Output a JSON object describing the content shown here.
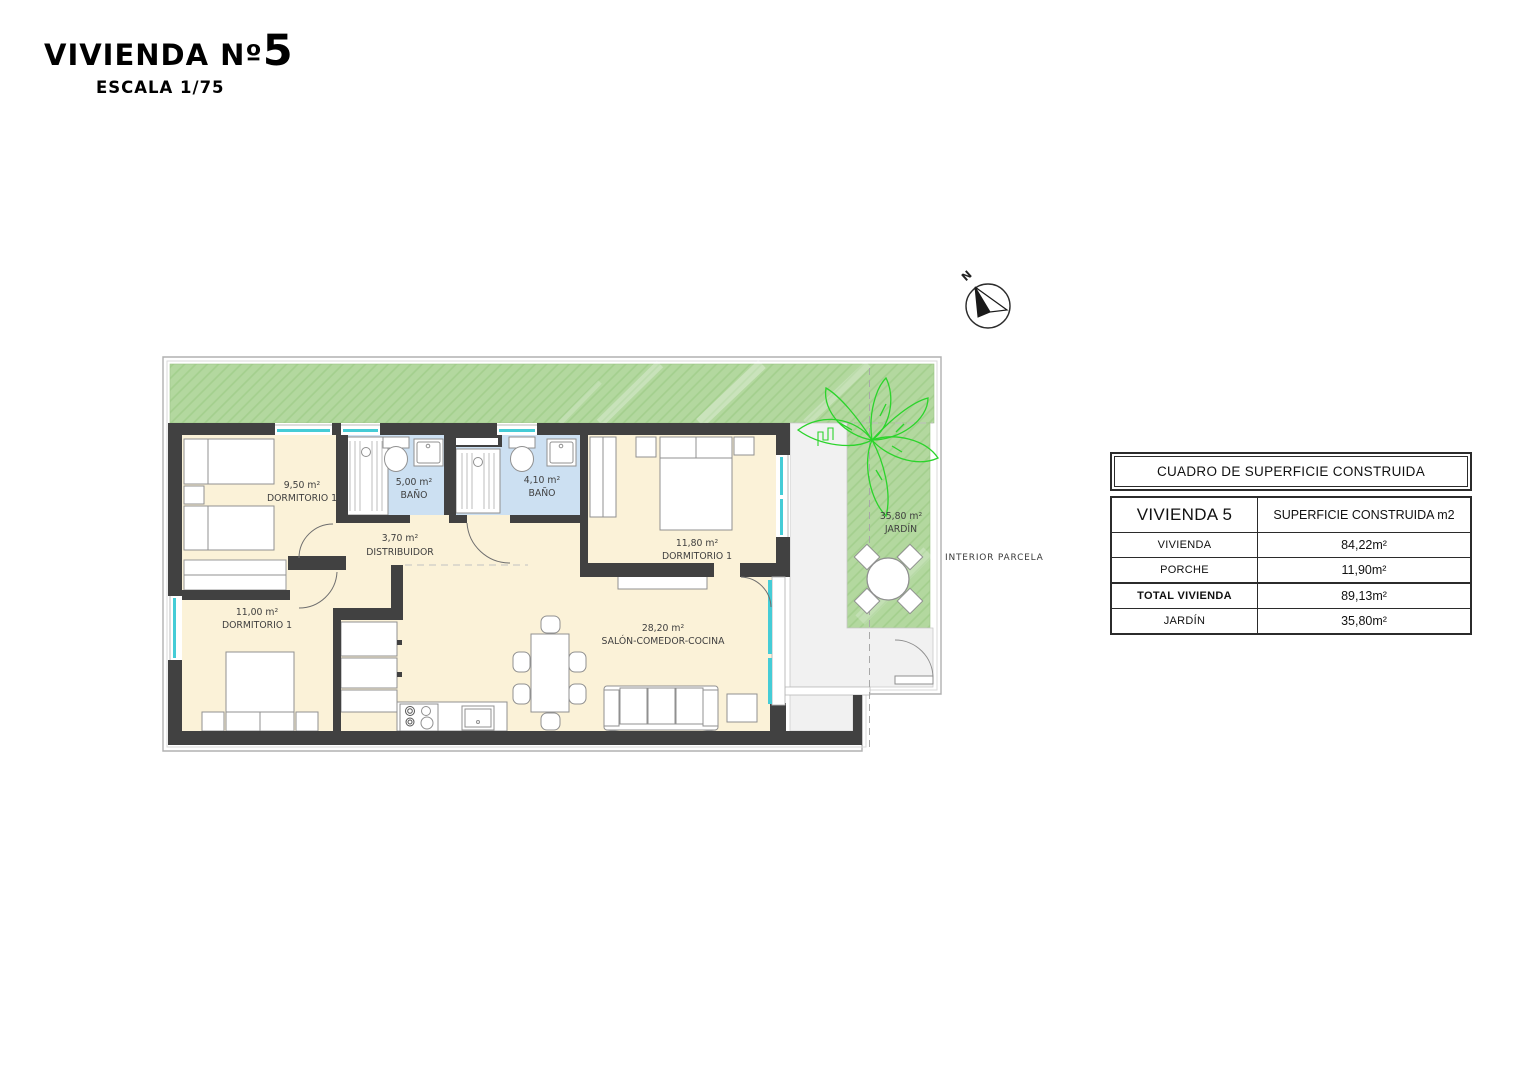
{
  "title": {
    "main": "VIVIENDA Nº",
    "number": "5",
    "scale": "ESCALA 1/75"
  },
  "compass": {
    "north_label": "N"
  },
  "plan": {
    "rooms": {
      "dorm_top_left": {
        "area": "9,50 m²",
        "name": "DORMITORIO 1"
      },
      "bath_1": {
        "area": "5,00 m²",
        "name": "BAÑO"
      },
      "bath_2": {
        "area": "4,10 m²",
        "name": "BAÑO"
      },
      "hall": {
        "area": "3,70 m²",
        "name": "DISTRIBUIDOR"
      },
      "dorm_right": {
        "area": "11,80 m²",
        "name": "DORMITORIO 1"
      },
      "dorm_bottom_left": {
        "area": "11,00 m²",
        "name": "DORMITORIO 1"
      },
      "living": {
        "area": "28,20 m²",
        "name": "SALÓN-COMEDOR-COCINA"
      },
      "garden": {
        "area": "35,80 m²",
        "name": "JARDÍN"
      }
    },
    "annotations": {
      "interior_parcela": "INTERIOR PARCELA"
    }
  },
  "surface_table": {
    "title": "CUADRO DE SUPERFICIE CONSTRUIDA",
    "col1_header": "VIVIENDA 5",
    "col2_header": "SUPERFICIE CONSTRUIDA m2",
    "rows": [
      {
        "label": "VIVIENDA",
        "value": "84,22m²"
      },
      {
        "label": "PORCHE",
        "value": "11,90m²"
      },
      {
        "label": "TOTAL  VIVIENDA",
        "value": "89,13m²"
      },
      {
        "label": "JARDÍN",
        "value": "35,80m²"
      }
    ]
  },
  "colors": {
    "wall": "#414141",
    "room_floor": "#fbf2d8",
    "bath_floor": "#cce0f2",
    "garden_green": "#b3d89f",
    "garden_hatch": "#a3cf8d",
    "porch_gray": "#f1f1f1",
    "window_glazing": "#45ccd6",
    "palm_green": "#2bd42b",
    "furniture_outline": "#909090"
  }
}
